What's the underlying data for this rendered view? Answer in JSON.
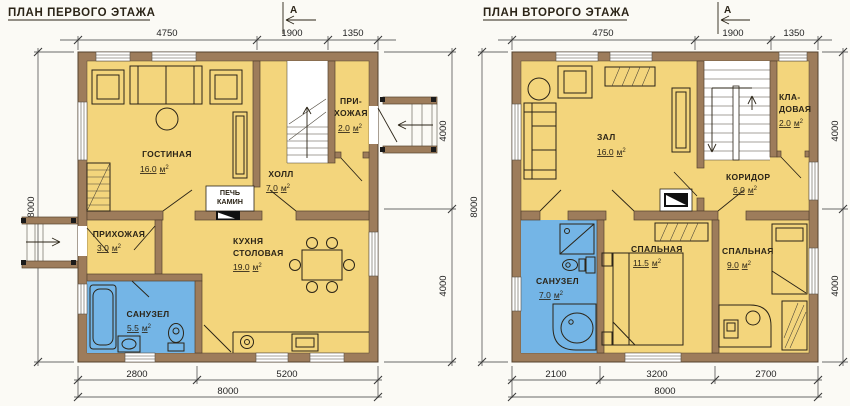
{
  "colors": {
    "bg": "#fbfaf5",
    "wall": "#9d7c5b",
    "wallStroke": "#54422e",
    "room": "#f3d57c",
    "wet": "#74b5e6",
    "ink": "#2b2417",
    "dim": "#3a3a3a"
  },
  "units": {
    "m": "м",
    "sup": "2"
  },
  "plans": [
    {
      "title": "ПЛАН ПЕРВОГО ЭТАЖА",
      "section_letter": "А",
      "dims": {
        "top": [
          "4750",
          "1900",
          "1350"
        ],
        "left": "8000",
        "right": [
          "4000",
          "4000"
        ],
        "bottom": [
          "2800",
          "5200"
        ],
        "bottom_total": "8000"
      },
      "rooms": [
        {
          "id": "living-room",
          "lines": [
            "ГОСТИНАЯ"
          ],
          "area": "16.0"
        },
        {
          "id": "entry-hall",
          "lines": [
            "ПРИ-",
            "ХОЖАЯ"
          ],
          "area": "2.0"
        },
        {
          "id": "hall",
          "lines": [
            "ХОЛЛ"
          ],
          "area": "7.0"
        },
        {
          "id": "hallway",
          "lines": [
            "ПРИХОЖАЯ"
          ],
          "area": "3.0"
        },
        {
          "id": "bathroom",
          "lines": [
            "САНУЗЕЛ"
          ],
          "area": "5.5"
        },
        {
          "id": "kitchen-dining",
          "lines": [
            "КУХНЯ",
            "СТОЛОВАЯ"
          ],
          "area": "19.0"
        }
      ],
      "stove_label": [
        "ПЕЧЬ",
        "КАМИН"
      ]
    },
    {
      "title": "ПЛАН ВТОРОГО ЭТАЖА",
      "section_letter": "А",
      "dims": {
        "top": [
          "4750",
          "1900",
          "1350"
        ],
        "left": "8000",
        "right": [
          "4000",
          "4000"
        ],
        "bottom": [
          "2100",
          "3200",
          "2700"
        ],
        "bottom_total": "8000"
      },
      "rooms": [
        {
          "id": "hall-room",
          "lines": [
            "ЗАЛ"
          ],
          "area": "16.0"
        },
        {
          "id": "storage",
          "lines": [
            "КЛА-",
            "ДОВАЯ"
          ],
          "area": "2.0"
        },
        {
          "id": "corridor",
          "lines": [
            "КОРИДОР"
          ],
          "area": "6.0"
        },
        {
          "id": "bathroom",
          "lines": [
            "САНУЗЕЛ"
          ],
          "area": "7.0"
        },
        {
          "id": "bedroom-1",
          "lines": [
            "СПАЛЬНАЯ"
          ],
          "area": "11.5"
        },
        {
          "id": "bedroom-2",
          "lines": [
            "СПАЛЬНАЯ"
          ],
          "area": "9.0"
        }
      ]
    }
  ]
}
